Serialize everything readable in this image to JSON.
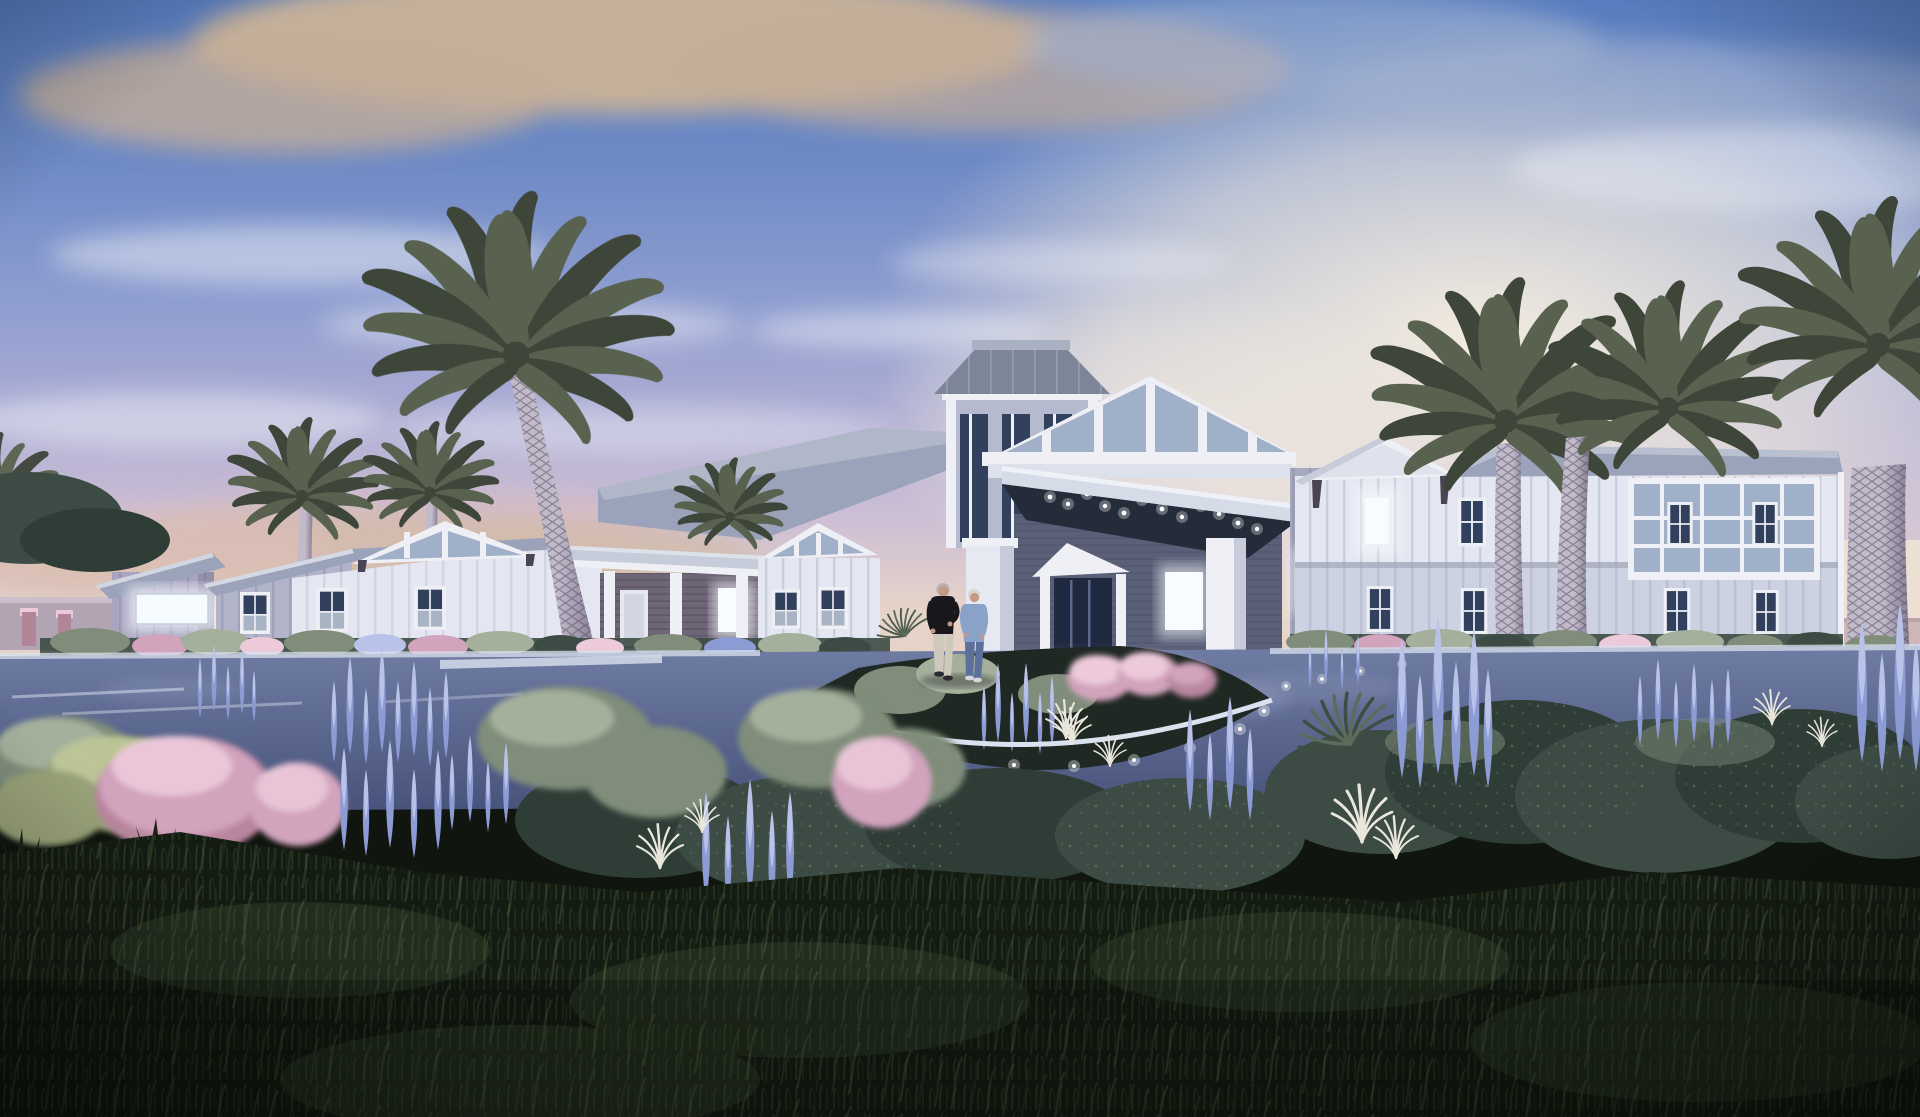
{
  "scene": {
    "title": "Architectural rendering of a coastal farmhouse-style senior living community at dusk",
    "time_of_day": "dusk",
    "description": "White board-and-batten one and two story buildings with gabled metal roofs and a cupola tower; a porte-cochere entry canopy with recessed downlights; a blank glowing sign panel on the left wing; tall palm trees; a curved drive with a landscaped island ringed by lighted curb; pink muhly grass, lavender flower spikes, sage shrubs and white plume grasses; dark lawn in the foreground; an elderly couple walking near the entrance.",
    "people": [
      {
        "name": "man",
        "clothing": "dark t-shirt and light pants"
      },
      {
        "name": "woman",
        "clothing": "light blue top and blue jeans"
      }
    ],
    "signage": {
      "text": ""
    }
  },
  "colors": {
    "sky_top": "#587dc0",
    "sky_upper": "#6e8ac6",
    "sky_mid": "#8f9ed0",
    "sky_soft": "#b0aed4",
    "sky_pink": "#cfc0d4",
    "sky_cream": "#e7d4c8",
    "sky_horizon": "#e4cdc5",
    "glow_cream": "#f7efdf",
    "cloud_gold": "#d0b695",
    "cloud_tan": "#c3ad98",
    "cloud_white": "#edf0f7",
    "cloud_blue": "#a3b2cf",
    "haze_pink": "#e2bfbc",
    "wall_white": "#e4e7f1",
    "wall_light": "#cdd2e2",
    "wall_gray": "#b2b4ca",
    "wall_mauve": "#a9a5c0",
    "porch_dark": "#6e6677",
    "trim": "#eef0f6",
    "roof_light": "#c6ccda",
    "roof_mid": "#9aa3b9",
    "roof_dark": "#7d8598",
    "glass": "#31405c",
    "glass_light": "#9fb0c8",
    "canopy_dark": "#242c3a",
    "window_glow": "#f8fcff",
    "sign_white": "#f6fbff",
    "led_white": "#ffffff",
    "trunk_light": "#c1bac8",
    "trunk_shade": "#837b92",
    "frond_dark": "#3e4539",
    "frond_mid": "#59624f",
    "frond_light": "#77816b",
    "road_top": "#6f7ca4",
    "road_bottom": "#47537b",
    "curb_light": "#d9e2ee",
    "island_bed": "#1f2822",
    "lawn_dark": "#141b12",
    "lawn_mid": "#283423",
    "hedge_dark": "#2f3d37",
    "hedge_mid": "#3c4b44",
    "sage": "#7f8d7a",
    "sage_light": "#a4b09b",
    "olive": "#97a077",
    "olive_light": "#bcc595",
    "pink": "#d2a3bd",
    "pink_light": "#eccada",
    "pink_deep": "#b9869f",
    "lavender": "#8d9bd4",
    "lavender_light": "#b9c3ea",
    "plume_white": "#e9e6dc",
    "sea_horizon": "#c9b4b4",
    "skin": "#c59a84",
    "shirt_dark": "#17171c",
    "pants_light": "#cfc9bd",
    "top_blue": "#8aa2c8",
    "jeans_blue": "#5d6f9b",
    "hair_gray": "#d9d6d2",
    "hair_tan": "#b9b2aa",
    "shadow": "#0a0e18"
  }
}
